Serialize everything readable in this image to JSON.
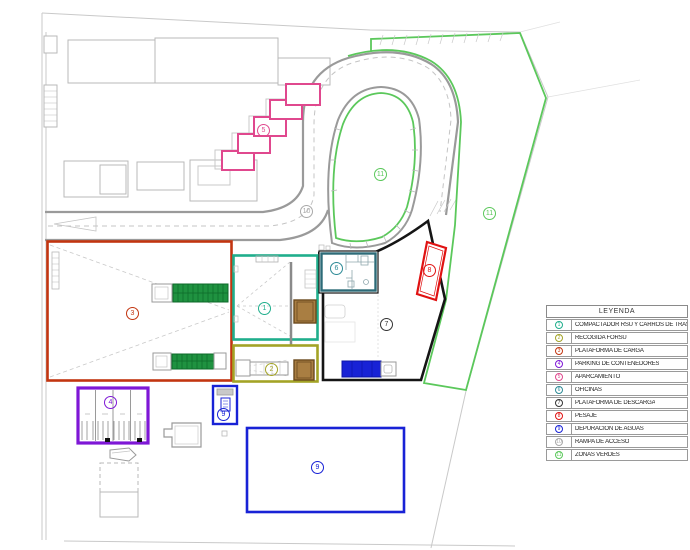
{
  "legend": {
    "title": "LEYENDA",
    "items": [
      {
        "num": "1",
        "label": "COMPACTADOR RSU Y CARROS DE TRASLACION",
        "color": "#1fae8c"
      },
      {
        "num": "2",
        "label": "RECOGIDA FORSU",
        "color": "#a3a326"
      },
      {
        "num": "3",
        "label": "PLATAFORMA DE CARGA",
        "color": "#c23510"
      },
      {
        "num": "4",
        "label": "PARKING DE CONTENEDORES",
        "color": "#7e17d6"
      },
      {
        "num": "5",
        "label": "APARCAMIENTO",
        "color": "#e0488e"
      },
      {
        "num": "6",
        "label": "OFICINAS",
        "color": "#2d8a96"
      },
      {
        "num": "7",
        "label": "PLATAFORMA DE DESCARGA",
        "color": "#333333"
      },
      {
        "num": "8",
        "label": "PESAJE",
        "color": "#e01212"
      },
      {
        "num": "9",
        "label": "DEPURACION DE AGUAS",
        "color": "#1822d6"
      },
      {
        "num": "10",
        "label": "RAMPA DE ACCESO",
        "color": "#a9a9a9"
      },
      {
        "num": "11",
        "label": "ZONAS VERDES",
        "color": "#5bc85b"
      }
    ]
  },
  "plan": {
    "marker_numbers": [
      "1",
      "2",
      "3",
      "4",
      "5",
      "6",
      "7",
      "8",
      "9",
      "10",
      "11"
    ],
    "colors": {
      "zone1_compactador": "#1fae8c",
      "zone2_recogida_forsu": "#a3a326",
      "zone3_plataforma_carga": "#c23510",
      "zone4_parking_contenedores": "#7e17d6",
      "zone5_aparcamiento": "#e0488e",
      "zone6_oficinas_border": "#2d6b78",
      "zone7_plataforma_descarga": "#151515",
      "zone8_pesaje": "#e01212",
      "zone9_depuracion_aguas": "#1822d6",
      "zone11_zonas_verdes": "#5bc85b",
      "road": "#9a9a9a",
      "boundary": "#c9c9c9",
      "container_green": "#1f9240",
      "compactor_brown": "#a97e42",
      "truck_blue": "#1822d6"
    }
  }
}
